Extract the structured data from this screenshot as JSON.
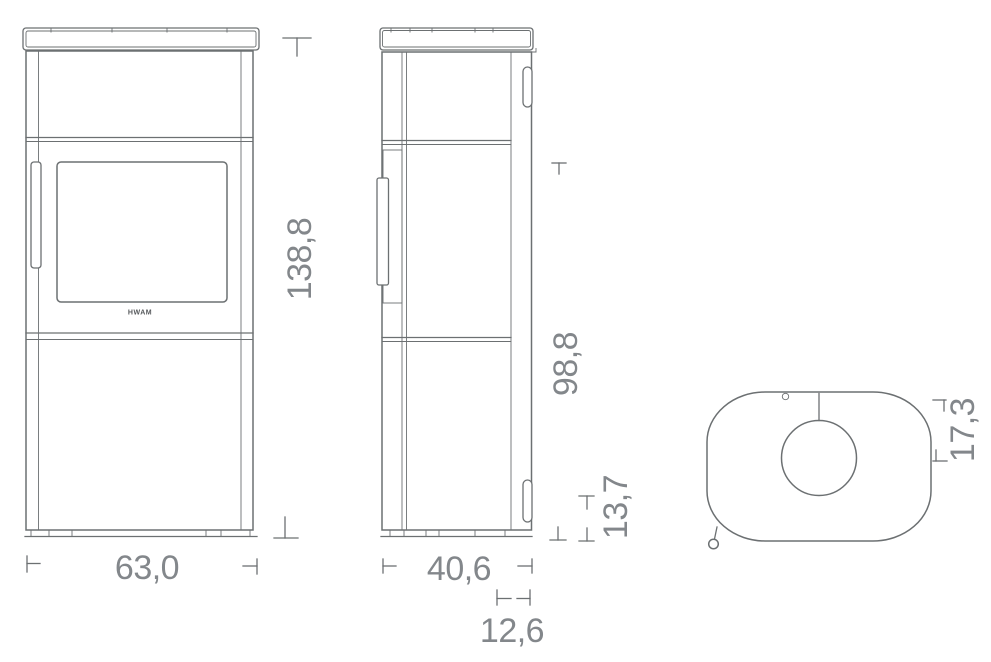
{
  "colors": {
    "background": "#ffffff",
    "line": "#6c7072",
    "dimension_text": "#83878b",
    "logo_text": "#54575a"
  },
  "brand": {
    "logo": "HWAM"
  },
  "dimensions": {
    "front_width": "63,0",
    "overall_height": "138,8",
    "side_depth": "40,6",
    "rear_height": "98,8",
    "rear_inlet_height": "13,7",
    "rear_offset": "12,6",
    "flue_center_from_back": "17,3"
  }
}
